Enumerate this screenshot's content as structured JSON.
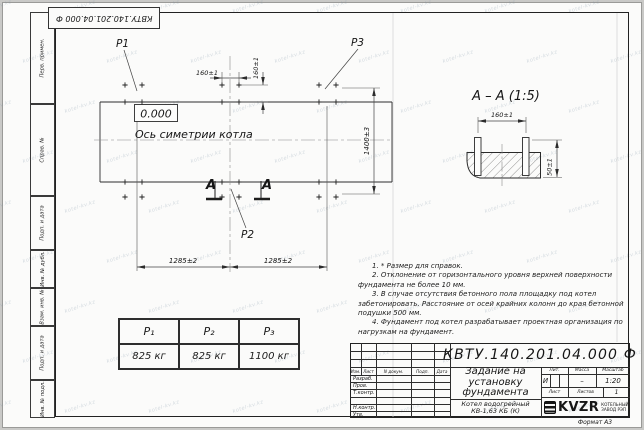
{
  "watermark": {
    "text": "kotel-kv.kz"
  },
  "frame": {
    "top_stamp": "КВТУ.140.201.04.000  Ф",
    "margin_labels": [
      "Перв. примен.",
      "Справ. №",
      "Подп. и дата",
      "Инв. № дубл.",
      "Взам. инв. №",
      "Подп. и дата",
      "Инв. № подл."
    ],
    "format_note": "Формат А3"
  },
  "plan": {
    "load_labels": {
      "p1": "P1",
      "p2": "P2",
      "p3": "P3"
    },
    "elevation_mark": "0.000",
    "axis_label": "Ось симетрии котла",
    "dims": {
      "bolt_h": "160±1",
      "bolt_v": "160±1",
      "span_left": "1285±2",
      "span_right": "1285±2",
      "width": "1400±3"
    },
    "section_letters": {
      "left": "А",
      "right": "А"
    }
  },
  "section_view": {
    "title": "А – А (1:5)",
    "dims": {
      "bolt_spacing": "160±1",
      "protrusion": "50±1"
    }
  },
  "load_table": {
    "headers": [
      "P₁",
      "P₂",
      "P₃"
    ],
    "values": [
      "825 кг",
      "825 кг",
      "1100 кг"
    ]
  },
  "notes": [
    "1. * Размер для справок.",
    "2. Отклонение от горизонтального уровня верхней поверхности фундамента не более 10 мм.",
    "3. В случае отсутствия бетонного пола площадку под котел забетонировать. Расстояние от осей крайних колонн до края бетонной подушки 500 мм.",
    "4. Фундамент под котел разрабатывает проектная организация по нагрузкам на фундамент."
  ],
  "title_block": {
    "doc_number": "КВТУ.140.201.04.000  Ф",
    "doc_title": "Задание на установку фундамента",
    "product": "Котел водогрейный КВ-1,63 КБ (К)",
    "change_header": [
      "Изм.",
      "Лист",
      "N докум.",
      "Подп.",
      "Дата"
    ],
    "signature_rows": [
      "Разраб.",
      "Пров.",
      "Т.контр.",
      "",
      "Н.контр.",
      "Утв."
    ],
    "lit": {
      "label": "Лит.",
      "value": "И"
    },
    "mass": {
      "label": "Масса",
      "value": "–"
    },
    "scale": {
      "label": "Масштаб",
      "value": "1:20"
    },
    "sheet": {
      "label": "Лист"
    },
    "sheets": {
      "label": "Листов",
      "value": "1"
    },
    "logo": {
      "text": "KVZR",
      "caption_line1": "КОТЕЛЬНЫЙ",
      "caption_line2": "ЗАВОД РЭП"
    }
  }
}
